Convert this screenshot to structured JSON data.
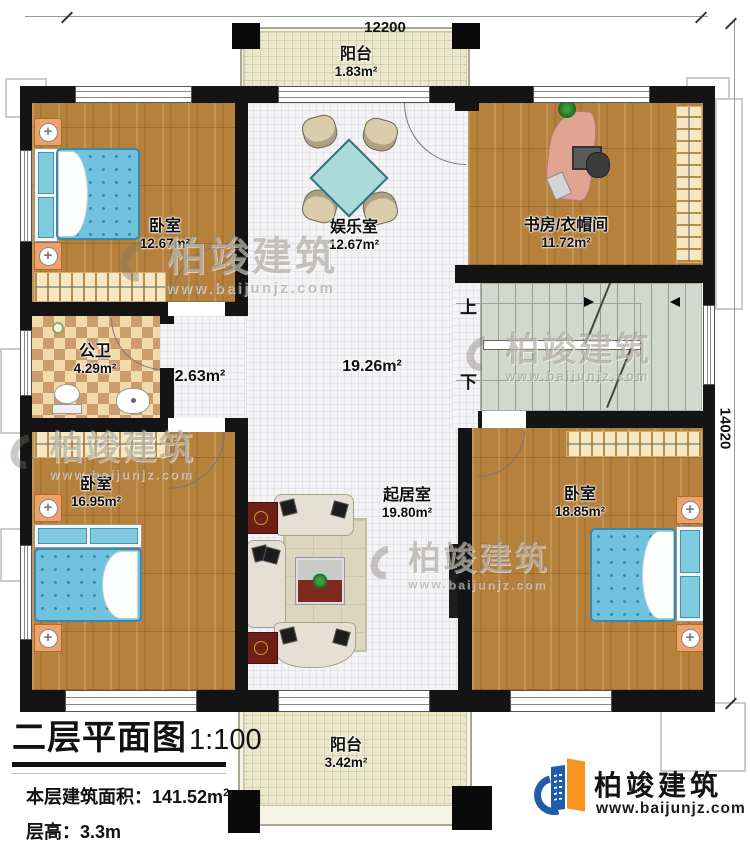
{
  "dimensions": {
    "top": "12200",
    "right": "14020"
  },
  "rooms": {
    "balcony_top": {
      "name": "阳台",
      "area": "1.83m²"
    },
    "bedroom_top_left": {
      "name": "卧室",
      "area": "12.67m²"
    },
    "entertainment": {
      "name": "娱乐室",
      "area": "12.67m²"
    },
    "study_cloakroom": {
      "name": "书房/衣帽间",
      "area": "11.72m²"
    },
    "bathroom": {
      "name": "公卫",
      "area": "4.29m²"
    },
    "hallway": {
      "area": "2.63m²"
    },
    "hall": {
      "area": "19.26m²"
    },
    "bedroom_bottom_left": {
      "name": "卧室",
      "area": "16.95m²"
    },
    "living_room": {
      "name": "起居室",
      "area": "19.80m²"
    },
    "bedroom_bottom_right": {
      "name": "卧室",
      "area": "18.85m²"
    },
    "balcony_bottom": {
      "name": "阳台",
      "area": "3.42m²"
    }
  },
  "stairs": {
    "up_label": "上",
    "down_label": "下"
  },
  "title_block": {
    "title": "二层平面图",
    "scale": "1:100",
    "floor_area_label": "本层建筑面积：",
    "floor_area_value": "141.52m",
    "floor_area_sup": "2",
    "floor_height_label": "层高：",
    "floor_height_value": "3.3m"
  },
  "branding": {
    "name": "柏竣建筑",
    "url": "www.baijunjz.com"
  },
  "colors": {
    "wall": "#141414",
    "wood_floor": "#b5813c",
    "tile_floor": "#f3f3f5",
    "balcony_tile": "#ebe7cd",
    "bathroom_tile_a": "#f2dbab",
    "bathroom_tile_b": "#cd9c6d",
    "stairs": "#d3d8cc",
    "bed_blue": "#70c2df",
    "logo_blue": "#1f5cab",
    "logo_orange": "#f7941e"
  }
}
